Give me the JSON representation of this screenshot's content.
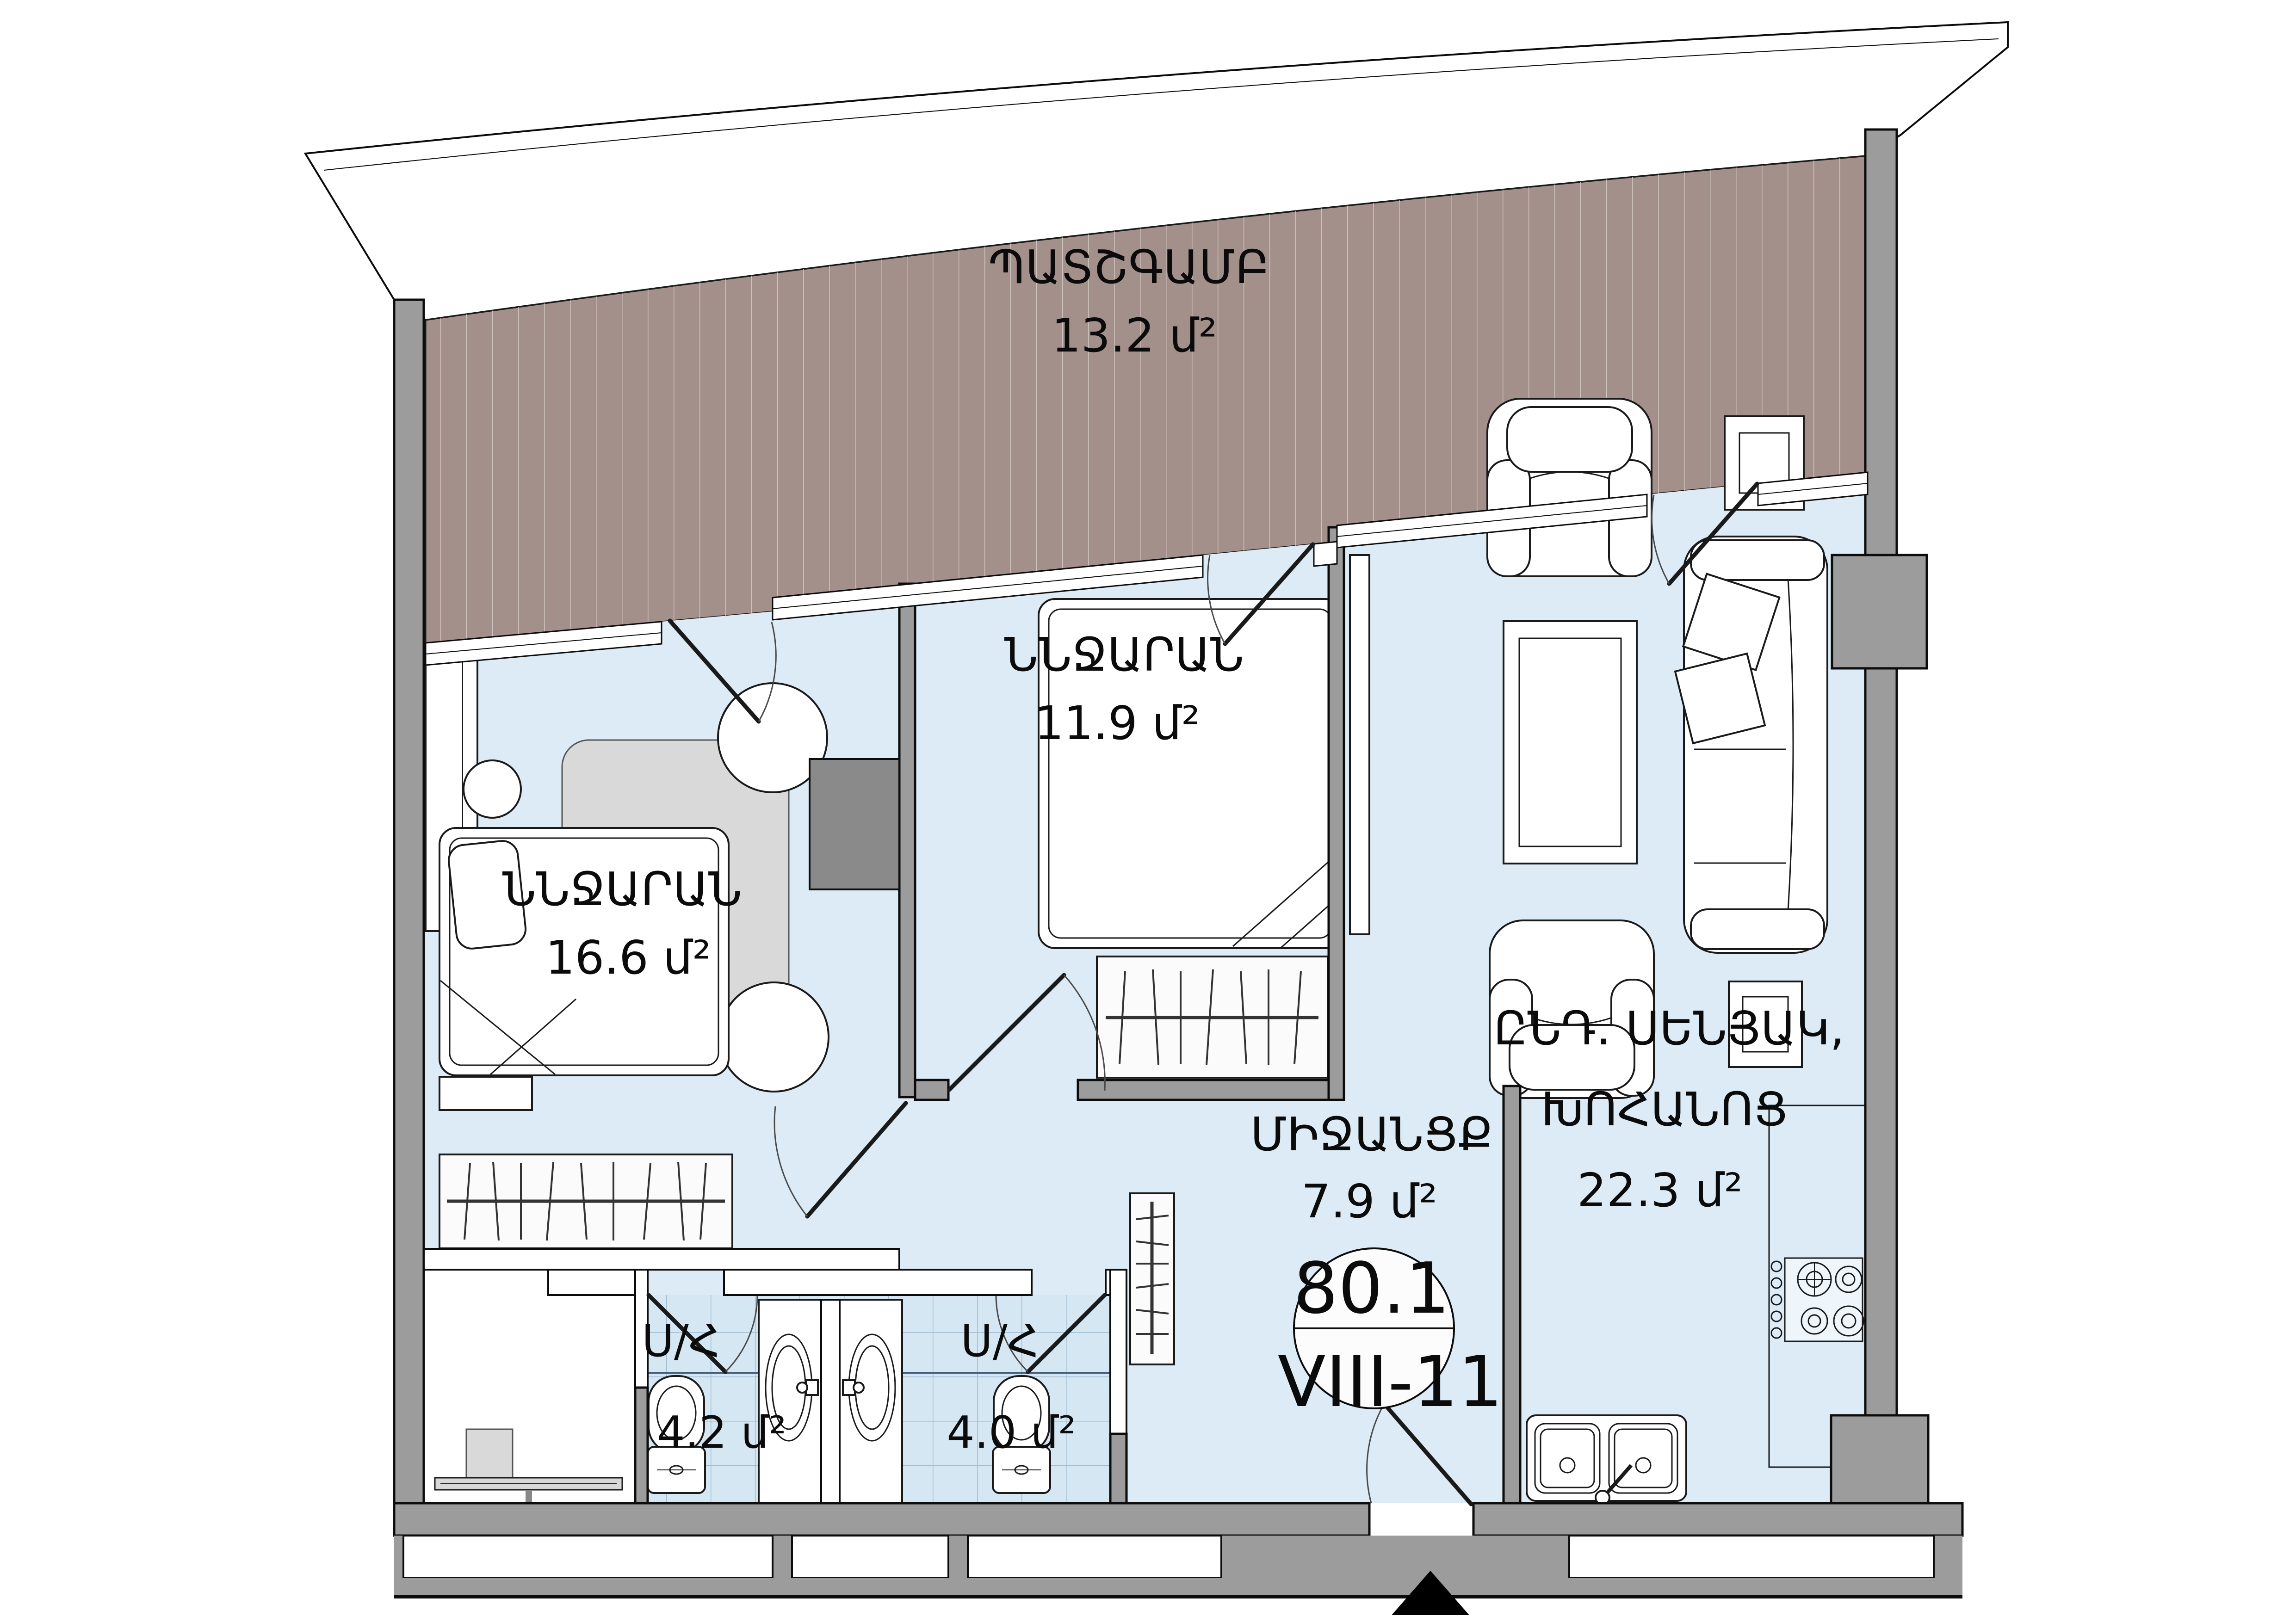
{
  "plan": {
    "title": "apartment-floor-plan",
    "rooms": {
      "balcony": {
        "name": "ՊԱՏՇԳԱՄԲ",
        "area": "13.2 մ²"
      },
      "bedroom_left": {
        "name": "ՆՆՋԱՐԱՆ",
        "area": "16.6 մ²"
      },
      "bedroom_middle": {
        "name": "ՆՆՋԱՐԱՆ",
        "area": "11.9 մ²"
      },
      "living_kitchen": {
        "name_line1": "ԸՆԴ. ՍԵՆՅԱԿ,",
        "name_line2": "ԽՈՀԱՆՈՑ",
        "area": "22.3 մ²"
      },
      "hallway": {
        "name": "ՄԻՋԱՆՑՔ",
        "area": "7.9 մ²"
      },
      "bathroom_1": {
        "name": "Ս/Հ",
        "area": "4.2 մ²"
      },
      "bathroom_2": {
        "name": "Ս/Հ",
        "area": "4.0 մ²"
      }
    },
    "stamp": {
      "floor_area": "80.1",
      "unit_number": "VIII-11"
    }
  },
  "colors": {
    "floor": "#dcebf5",
    "bath_tile": "#d5e7f3",
    "wall_gray": "#9c9c9c",
    "balcony_deck": "#a3908a",
    "line_ink": "#111111"
  }
}
